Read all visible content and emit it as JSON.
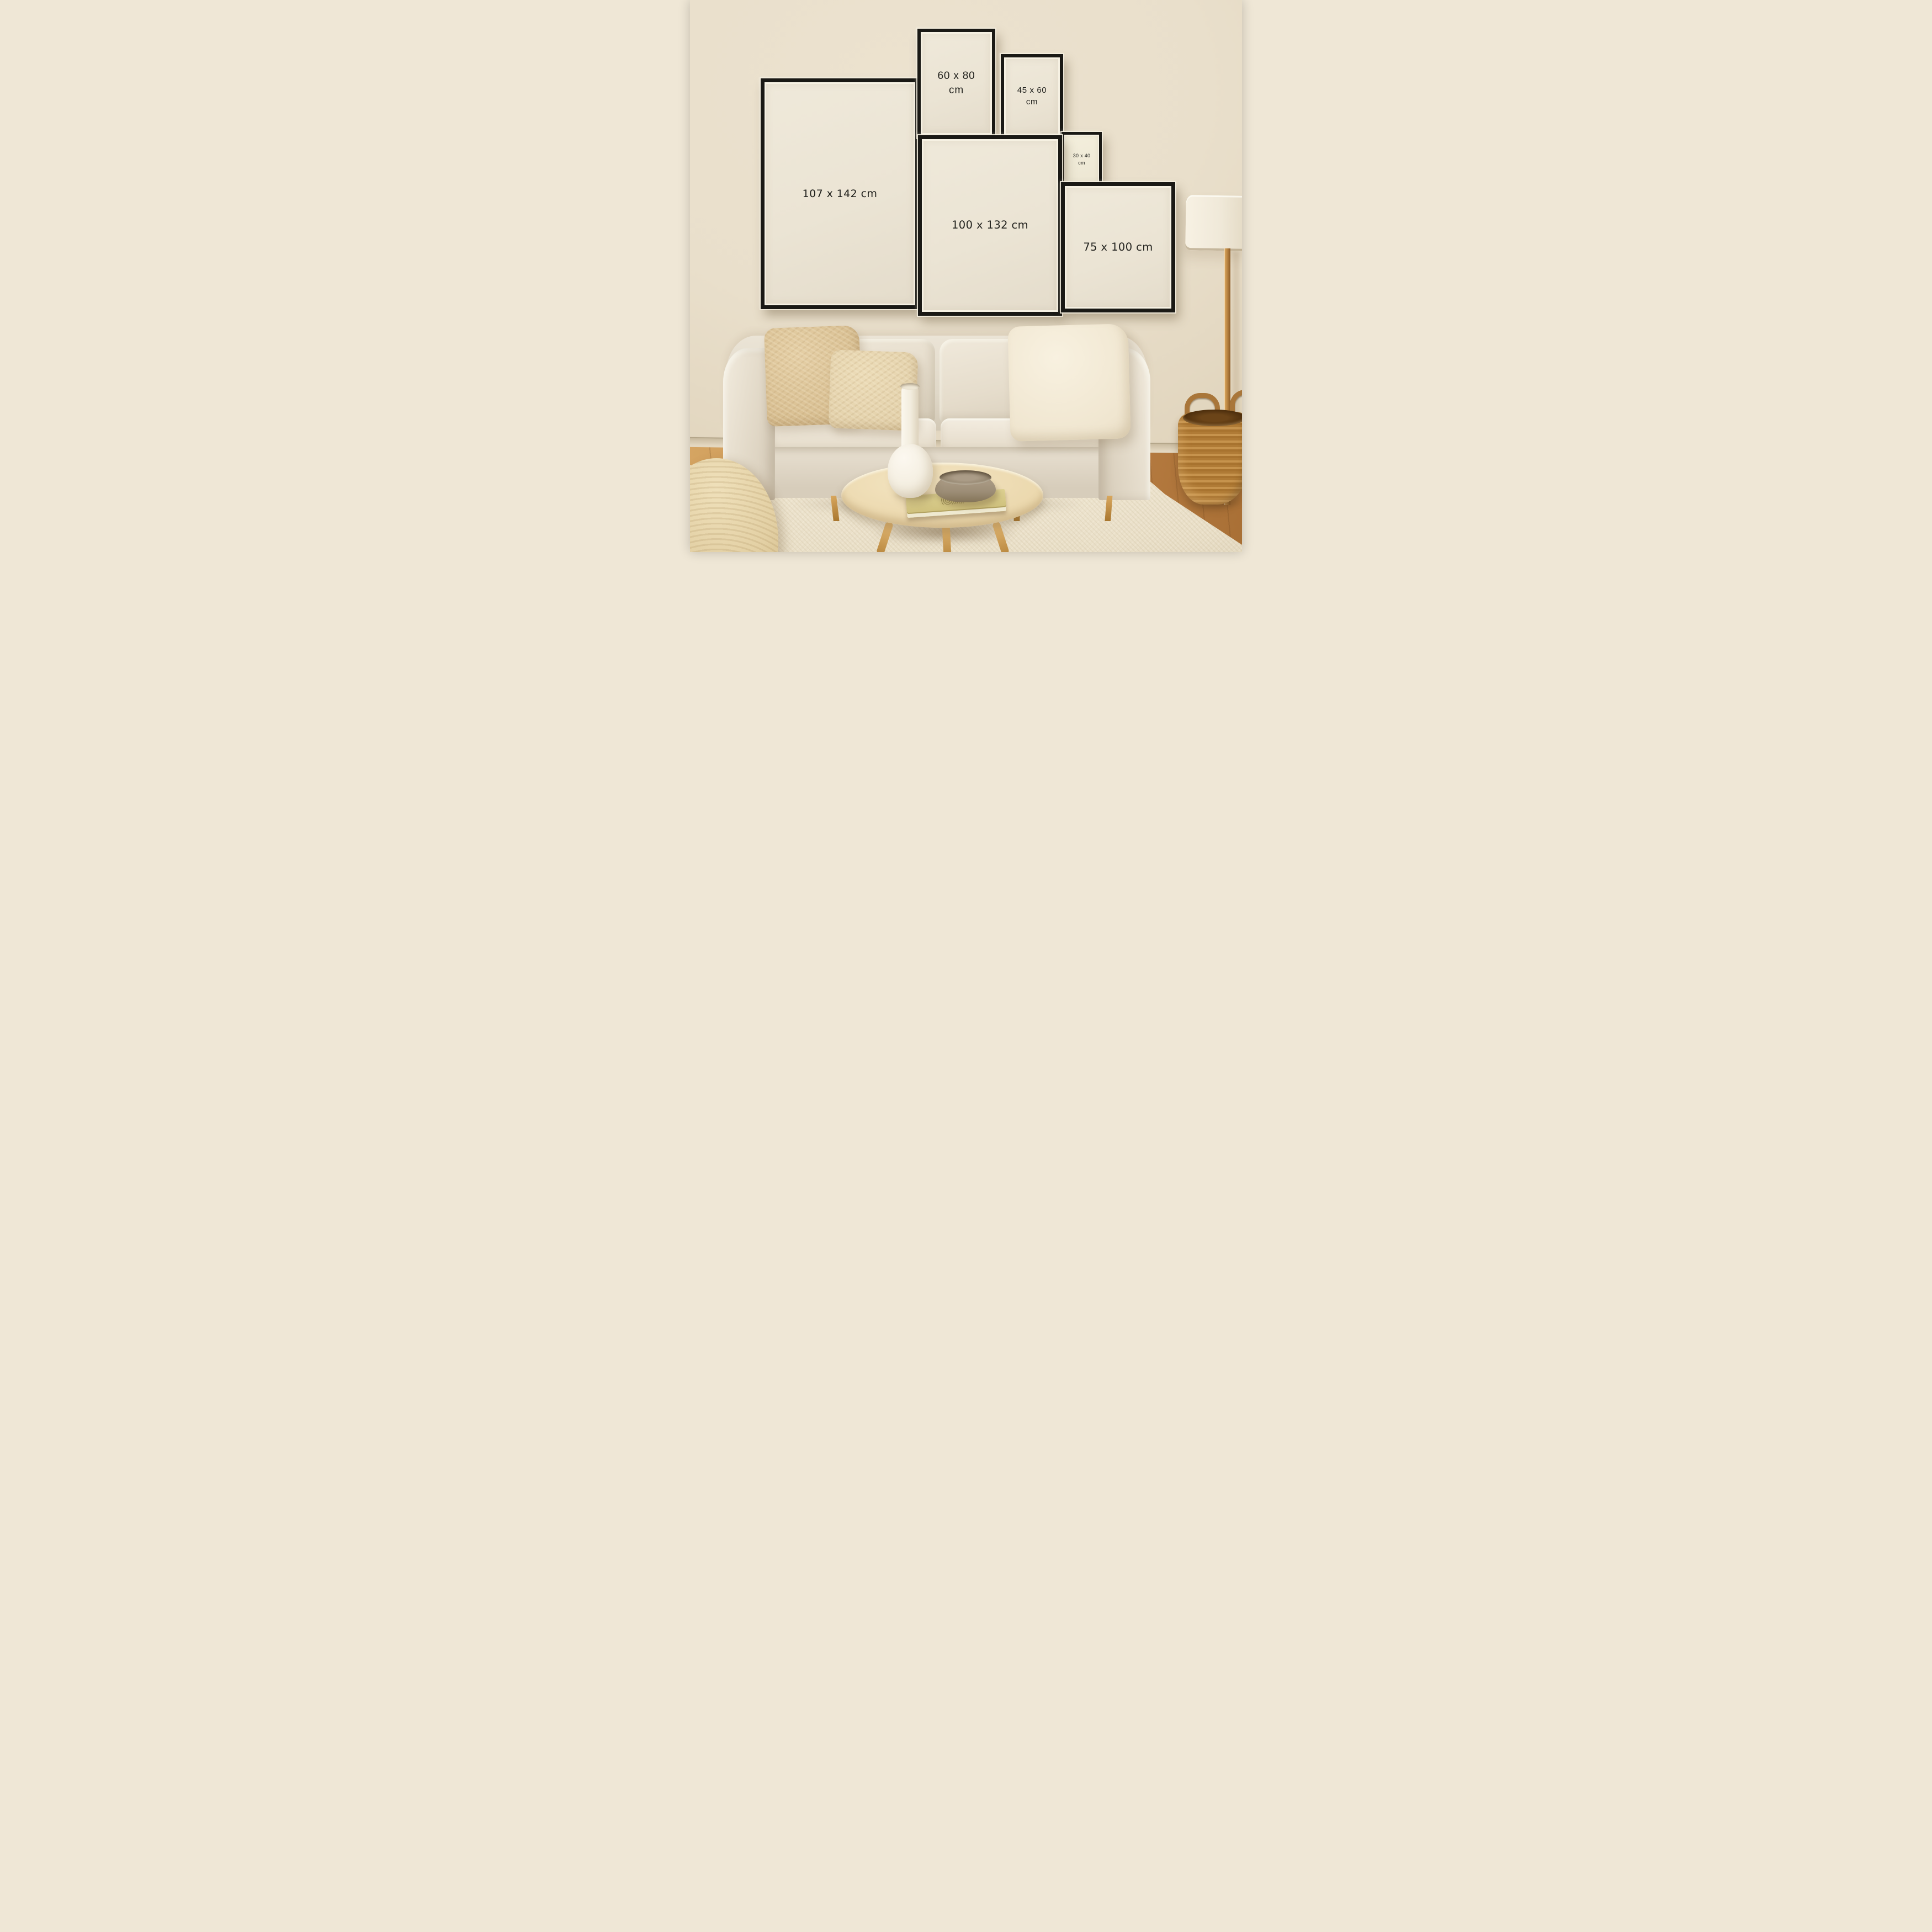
{
  "frames": [
    {
      "id": "frame-107x142",
      "lines": [
        "107 x 142 cm",
        ""
      ]
    },
    {
      "id": "frame-60x80",
      "lines": [
        "60 x 80",
        "cm"
      ]
    },
    {
      "id": "frame-45x60",
      "lines": [
        "45 x 60",
        "cm"
      ]
    },
    {
      "id": "frame-30x40",
      "lines": [
        "30 x 40",
        "cm"
      ]
    },
    {
      "id": "frame-100x132",
      "lines": [
        "100 x 132 cm",
        ""
      ]
    },
    {
      "id": "frame-75x100",
      "lines": [
        "75 x 100 cm",
        ""
      ]
    }
  ],
  "palette": {
    "wall": "#ece2cf",
    "wall_dark": "#dbceb3",
    "baseboard": "#e4d8c1",
    "floor_wood": "#c08449",
    "rug": "#e9dfc8",
    "frame_black": "#1a1915",
    "frame_mat": "#f6f1e3",
    "frame_paper": "#ebe4d4",
    "label_text": "#21211d",
    "sofa": "#e0d8c8",
    "pillow_tan": "#d6bc8e",
    "pillow_tan_light": "#e3d1ab",
    "pillow_cream": "#f0e6d0",
    "lamp_shade": "#f0e9d9",
    "lamp_pole": "#b5803f",
    "table_wood": "#e9d5a9",
    "vase": "#f2ecdd",
    "bowl": "#9c8d76",
    "book": "#ddd192",
    "pouf": "#e3d0a4",
    "basket": "#c6934d",
    "basket_dark": "#6b4418"
  }
}
